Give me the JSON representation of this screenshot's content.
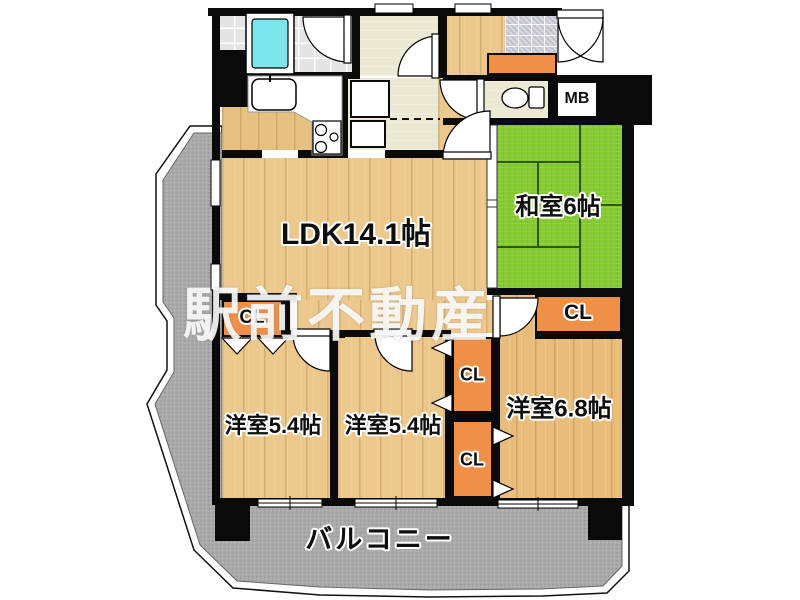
{
  "floorplan": {
    "watermark": "駅前不動産",
    "rooms": {
      "ldk": "LDK14.1帖",
      "washitsu": "和室6帖",
      "western_left": "洋室5.4帖",
      "western_middle": "洋室5.4帖",
      "western_right": "洋室6.8帖",
      "balcony": "バルコニー"
    },
    "labels": {
      "closet": "CL",
      "meter_box": "MB"
    },
    "colors": {
      "tatami_green": "#85ca32",
      "wood_floor": "#ecc88d",
      "closet_orange": "#ef9049",
      "balcony_gray": "#a9a9a9",
      "bathtub_cyan": "#7de5ec",
      "wall_black": "#0a0a0a"
    }
  }
}
